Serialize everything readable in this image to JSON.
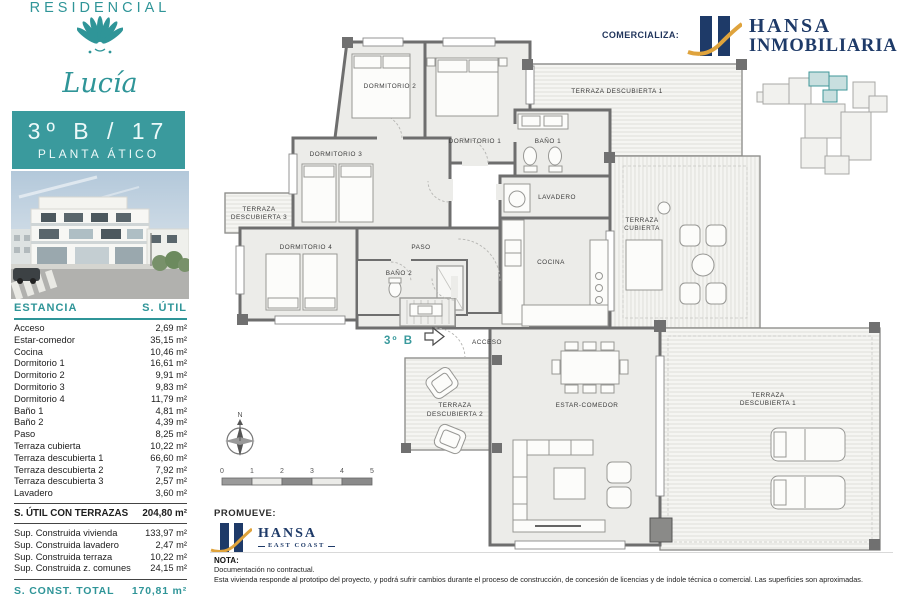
{
  "sidebar": {
    "brand_top": "RESIDENCIAL",
    "brand_script": "Lucía",
    "unit_title": "3º B / 17",
    "unit_subtitle": "PLANTA ÁTICO",
    "table": {
      "col_estancia": "ESTANCIA",
      "col_sutil": "S. ÚTIL",
      "rows": [
        {
          "label": "Acceso",
          "value": "2,69 m²"
        },
        {
          "label": "Estar-comedor",
          "value": "35,15 m²"
        },
        {
          "label": "Cocina",
          "value": "10,46 m²"
        },
        {
          "label": "Dormitorio 1",
          "value": "16,61 m²"
        },
        {
          "label": "Dormitorio 2",
          "value": "9,91 m²"
        },
        {
          "label": "Dormitorio 3",
          "value": "9,83 m²"
        },
        {
          "label": "Dormitorio 4",
          "value": "11,79 m²"
        },
        {
          "label": "Baño 1",
          "value": "4,81 m²"
        },
        {
          "label": "Baño 2",
          "value": "4,39 m²"
        },
        {
          "label": "Paso",
          "value": "8,25 m²"
        },
        {
          "label": "Terraza cubierta",
          "value": "10,22 m²"
        },
        {
          "label": "Terraza descubierta 1",
          "value": "66,60 m²"
        },
        {
          "label": "Terraza descubierta 2",
          "value": "7,92 m²"
        },
        {
          "label": "Terraza descubierta 3",
          "value": "2,57 m²"
        },
        {
          "label": "Lavadero",
          "value": "3,60 m²"
        }
      ],
      "subtotal_label": "S. ÚTIL CON TERRAZAS",
      "subtotal_value": "204,80 m²",
      "built_rows": [
        {
          "label": "Sup. Construida vivienda",
          "value": "133,97 m²"
        },
        {
          "label": "Sup. Construida lavadero",
          "value": "2,47 m²"
        },
        {
          "label": "Sup. Construida terraza",
          "value": "10,22 m²"
        },
        {
          "label": "Sup. Construida z. comunes",
          "value": "24,15 m²"
        }
      ],
      "total_label": "S. CONST. TOTAL",
      "total_value": "170,81 m²"
    }
  },
  "header": {
    "comercializa": "COMERCIALIZA:",
    "hansa_line1": "HANSA",
    "hansa_line2": "INMOBILIARIA"
  },
  "promueve": {
    "label": "PROMUEVE:",
    "hansa_line1": "HANSA",
    "hansa_line2": "EAST COAST"
  },
  "nota": {
    "title": "NOTA:",
    "line1": "Documentación no contractual.",
    "line2": "Esta vivienda responde al prototipo del proyecto, y podrá sufrir cambios durante el proceso de construcción, de concesión de licencias y de índole técnica o comercial. Las superficies son aproximadas."
  },
  "plan": {
    "dorm1": "DORMITORIO 1",
    "dorm2": "DORMITORIO 2",
    "dorm3": "DORMITORIO 3",
    "dorm4": "DORMITORIO 4",
    "paso": "PASO",
    "bano1": "BAÑO 1",
    "bano2": "BAÑO 2",
    "lavadero": "LAVADERO",
    "cocina": "COCINA",
    "estar": "ESTAR-COMEDOR",
    "acceso": "ACCESO",
    "unit_label": "3º B",
    "terraza_desc1_top": "TERRAZA DESCUBIERTA 1",
    "terraza_word": "TERRAZA",
    "cubierta_line2": "CUBIERTA",
    "desc1_line2": "DESCUBIERTA 1",
    "desc2_line2": "DESCUBIERTA 2",
    "desc3_line2": "DESCUBIERTA 3",
    "north": "N",
    "scale": {
      "s0": "0",
      "s1": "1",
      "s2": "2",
      "s3": "3",
      "s4": "4",
      "s5": "5"
    }
  },
  "colors": {
    "teal": "#3a9a9d",
    "navy": "#1e3a68",
    "gold": "#dfa33c"
  }
}
